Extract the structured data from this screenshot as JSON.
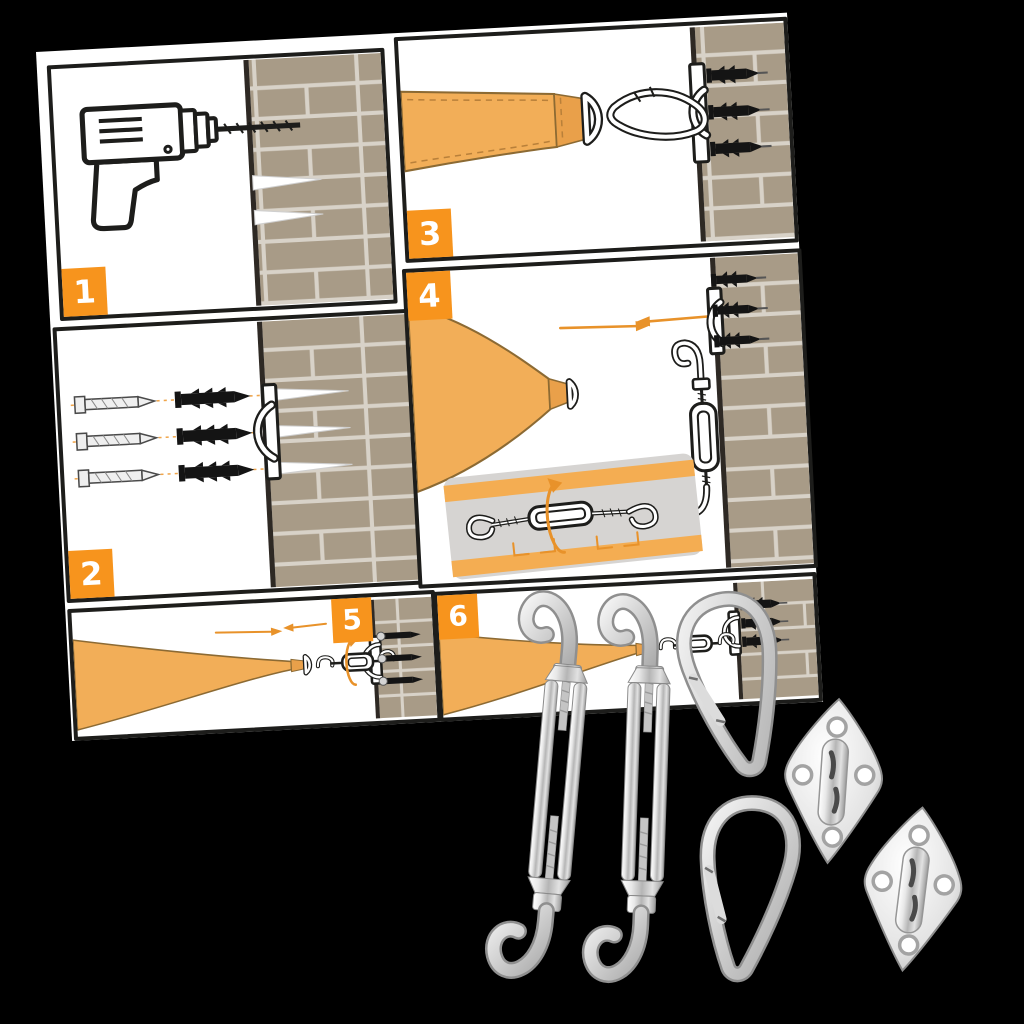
{
  "colors": {
    "background": "#000000",
    "paper": "#ffffff",
    "panel_border": "#1d1d1b",
    "badge": "#f7941d",
    "sail": "#f2ae58",
    "sail_outline": "#8c6a33",
    "brick": "#a89b87",
    "mortar": "#d8d2c8",
    "wall_edge": "#2e2924",
    "arrow": "#e8922a",
    "inset_bg": "#d6d4d2",
    "inset_band": "#f4ad52",
    "plug": "#141414"
  },
  "steps": [
    {
      "label": "1",
      "icons": [
        "power-drill-icon",
        "brick-wall",
        "drill-hole"
      ]
    },
    {
      "label": "2",
      "icons": [
        "screw-icon",
        "wall-plug-icon",
        "pad-eye-plate-icon",
        "brick-wall",
        "guide-dotted-line"
      ]
    },
    {
      "label": "3",
      "icons": [
        "sail-strap-icon",
        "d-ring-icon",
        "carabiner-icon",
        "pad-eye-plate-icon",
        "brick-wall"
      ]
    },
    {
      "label": "4",
      "icons": [
        "sail-corner-icon",
        "d-ring-icon",
        "direction-arrow-icon",
        "turnbuckle-icon",
        "pad-eye-plate-icon",
        "brick-wall",
        "turnbuckle-detail-inset",
        "rotation-arrow-icon"
      ]
    },
    {
      "label": "5",
      "icons": [
        "sail-corner-icon",
        "d-ring-icon",
        "turnbuckle-icon",
        "rotation-arrow-icon",
        "direction-arrow-icon",
        "pad-eye-plate-icon",
        "brick-wall"
      ]
    },
    {
      "label": "6",
      "icons": [
        "sail-corner-icon",
        "d-ring-icon",
        "turnbuckle-icon",
        "pad-eye-plate-icon",
        "brick-wall"
      ]
    }
  ],
  "hardware_kit": [
    {
      "icon": "turnbuckle-double-hook-photo"
    },
    {
      "icon": "turnbuckle-double-hook-photo"
    },
    {
      "icon": "snap-hook-carabiner-photo"
    },
    {
      "icon": "snap-hook-carabiner-photo"
    },
    {
      "icon": "diamond-pad-eye-photo"
    },
    {
      "icon": "diamond-pad-eye-photo"
    }
  ]
}
